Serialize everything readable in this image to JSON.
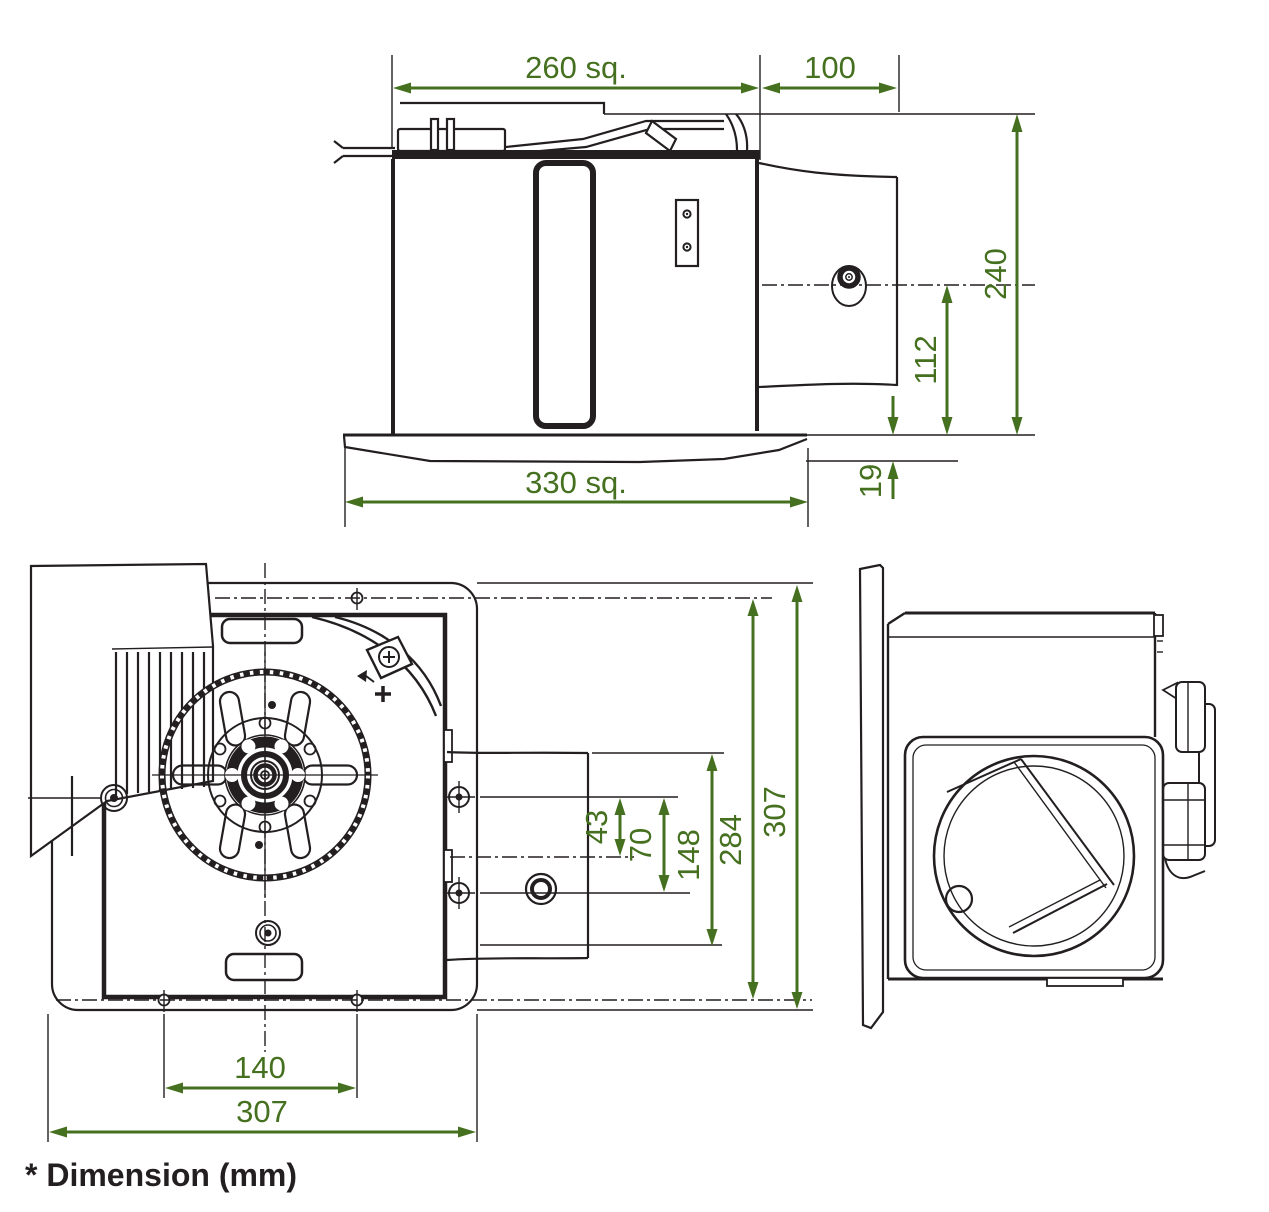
{
  "note": "* Dimension (mm)",
  "colors": {
    "dimension": "#45701f",
    "ink": "#231f20",
    "background": "#ffffff"
  },
  "dimensions": {
    "top_view": {
      "body_width": "260 sq.",
      "duct_length": "100",
      "overall_height": "240",
      "duct_centerline_to_flange": "112",
      "flange_thickness": "19",
      "flange_width": "330 sq."
    },
    "bottom_view": {
      "screw_to_duct_centerline": "43",
      "wall_screw_pitch": "70",
      "duct_opening_height": "148",
      "mounting_pitch_vertical": "284",
      "housing_depth": "307",
      "mounting_pitch_horizontal": "140",
      "housing_width": "307"
    }
  }
}
